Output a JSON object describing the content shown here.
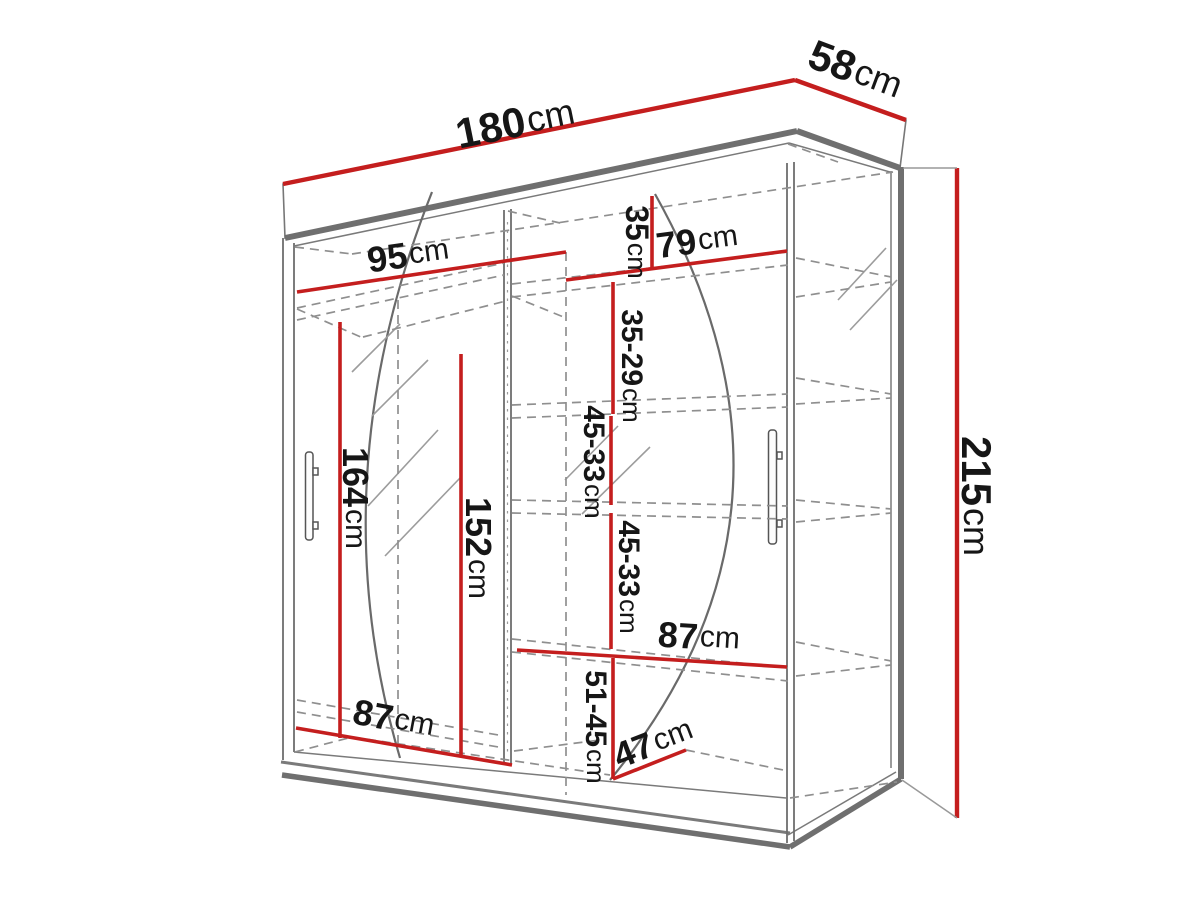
{
  "diagram": {
    "kind": "wardrobe-dimension-diagram",
    "unit": "cm",
    "colors": {
      "dimension_line": "#c41e1e",
      "structure": "#6d6d6d",
      "hidden_edge": "#8f8f8f",
      "label_text": "#161616"
    }
  },
  "dimensions": {
    "overall_width": {
      "value": "180",
      "unit": "cm"
    },
    "overall_depth": {
      "value": "58",
      "unit": "cm"
    },
    "overall_height": {
      "value": "215",
      "unit": "cm"
    },
    "left_section_width": {
      "value": "95",
      "unit": "cm"
    },
    "right_section_width": {
      "value": "79",
      "unit": "cm"
    },
    "top_shelf_spacing": {
      "value": "35",
      "unit": "cm"
    },
    "second_shelf_spacing": {
      "value": "35-29",
      "unit": "cm"
    },
    "third_shelf_spacing": {
      "value": "45-33",
      "unit": "cm"
    },
    "fourth_shelf_spacing": {
      "value": "45-33",
      "unit": "cm"
    },
    "hanging_height": {
      "value": "164",
      "unit": "cm"
    },
    "inner_height": {
      "value": "152",
      "unit": "cm"
    },
    "middle_shelf_width": {
      "value": "87",
      "unit": "cm"
    },
    "bottom_shelf_width": {
      "value": "87",
      "unit": "cm"
    },
    "bottom_shelf_spacing": {
      "value": "51-45",
      "unit": "cm"
    },
    "bottom_depth": {
      "value": "47",
      "unit": "cm"
    }
  }
}
